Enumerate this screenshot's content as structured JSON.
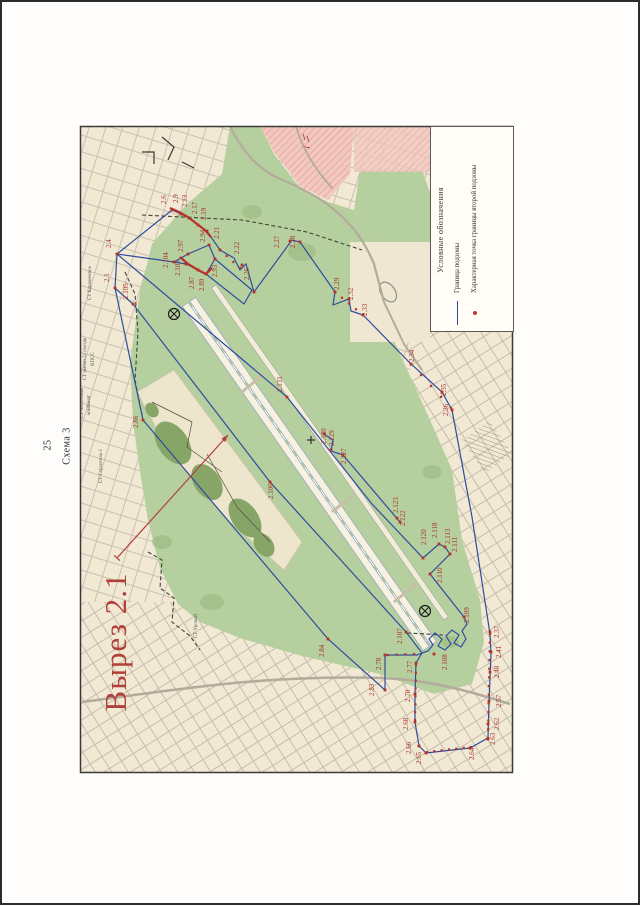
{
  "page": {
    "number": "25",
    "scheme": "Схема 3",
    "cutout": "Вырез 2.1"
  },
  "legend": {
    "title": "Условные обозначения",
    "items": [
      {
        "symbol": "line",
        "label": "Граница  подзоны"
      },
      {
        "symbol": "point",
        "label": "Характерная точка границы второй подзоны"
      }
    ]
  },
  "map": {
    "colors": {
      "boundary": "#2e4da0",
      "point": "#b5332a",
      "point_label": "#a8332c",
      "dashed": "#3f4538",
      "area_label": "#55534a",
      "arrow": "#b2403a"
    },
    "area_labels": [
      [
        "СТ Карачевское",
        89,
        281
      ],
      [
        "СТ имени 21 съезда",
        84,
        357
      ],
      [
        "КПСС",
        92,
        357
      ],
      [
        "СТ Молочный",
        81,
        401
      ],
      [
        "комбинат",
        88,
        403
      ],
      [
        "СТ Строитель-1",
        100,
        464
      ],
      [
        "СТ Урожай",
        195,
        624
      ]
    ],
    "points": [
      [
        "2.1",
        113,
        286,
        107,
        280
      ],
      [
        "2.4",
        115,
        252,
        109,
        246
      ],
      [
        "2.6",
        170,
        208,
        164,
        202
      ],
      [
        "2.9",
        179,
        212,
        176,
        201
      ],
      [
        "2.13",
        187,
        216,
        185,
        205
      ],
      [
        "2.17",
        196,
        223,
        195,
        212
      ],
      [
        "2.19",
        205,
        229,
        204,
        218
      ],
      [
        "2.21",
        218,
        248,
        217,
        237
      ],
      [
        "2.22",
        240,
        263,
        237,
        252
      ],
      [
        "2.26",
        252,
        290,
        247,
        278
      ],
      [
        "2.27",
        288,
        239,
        277,
        246
      ],
      [
        "2.28",
        298,
        240,
        293,
        246
      ],
      [
        "2.29",
        333,
        290,
        337,
        288
      ],
      [
        "2.32",
        347,
        297,
        351,
        298
      ],
      [
        "2.33",
        361,
        313,
        365,
        314
      ],
      [
        "2.34",
        409,
        362,
        412,
        360
      ],
      [
        "2.35",
        440,
        390,
        444,
        394
      ],
      [
        "2.36",
        450,
        408,
        446,
        414
      ],
      [
        "2.37",
        488,
        630,
        497,
        636
      ],
      [
        "2.41",
        489,
        650,
        499,
        656
      ],
      [
        "2.48",
        488,
        670,
        497,
        676
      ],
      [
        "2.57",
        487,
        699,
        499,
        705
      ],
      [
        "2.62",
        486,
        722,
        497,
        728
      ],
      [
        "2.63",
        486,
        737,
        493,
        743
      ],
      [
        "2.64",
        468,
        746,
        472,
        758
      ],
      [
        "2.65",
        424,
        751,
        419,
        762
      ],
      [
        "2.66",
        417,
        744,
        409,
        752
      ],
      [
        "2.68",
        413,
        720,
        406,
        728
      ],
      [
        "2.70",
        413,
        692,
        408,
        700
      ],
      [
        "2.77",
        414,
        661,
        410,
        671
      ],
      [
        "2.78",
        383,
        653,
        379,
        668
      ],
      [
        "2.83",
        383,
        688,
        372,
        694
      ],
      [
        "2.84",
        326,
        637,
        322,
        655
      ],
      [
        "2.86",
        141,
        418,
        136,
        426
      ],
      [
        "2.87",
        196,
        268,
        192,
        287
      ],
      [
        "2.89",
        204,
        272,
        202,
        289
      ],
      [
        "2.93",
        213,
        257,
        215,
        275
      ],
      [
        "2.94",
        207,
        243,
        203,
        240
      ],
      [
        "2.97",
        186,
        252,
        181,
        250
      ],
      [
        "2.103",
        184,
        262,
        178,
        274
      ],
      [
        "2.104",
        172,
        260,
        166,
        266
      ],
      [
        "2.105",
        131,
        302,
        126,
        297
      ],
      [
        "2.106",
        268,
        480,
        271,
        497
      ],
      [
        "2.107",
        404,
        630,
        400,
        642
      ],
      [
        "2.108",
        432,
        652,
        445,
        668
      ],
      [
        "2.109",
        462,
        615,
        467,
        621
      ],
      [
        "2.110",
        428,
        572,
        440,
        581
      ],
      [
        "2.111",
        448,
        552,
        455,
        550
      ],
      [
        "2.113",
        443,
        545,
        448,
        542
      ],
      [
        "2.118",
        437,
        542,
        435,
        536
      ],
      [
        "2.120",
        421,
        556,
        424,
        543
      ],
      [
        "2.122",
        398,
        520,
        403,
        524
      ],
      [
        "2.123",
        395,
        516,
        396,
        511
      ],
      [
        "2.127",
        341,
        453,
        344,
        462
      ],
      [
        "2.129",
        329,
        448,
        332,
        444
      ],
      [
        "2.130",
        322,
        432,
        324,
        442
      ],
      [
        "2.131",
        285,
        395,
        280,
        390
      ]
    ],
    "boundary": [
      [
        [
          113,
          286
        ],
        [
          115,
          252
        ],
        [
          170,
          208
        ],
        [
          179,
          212
        ],
        [
          187,
          216
        ],
        [
          196,
          223
        ],
        [
          205,
          229
        ],
        [
          218,
          248
        ],
        [
          232,
          256
        ],
        [
          238,
          268
        ],
        [
          244,
          262
        ],
        [
          252,
          290
        ],
        [
          290,
          238
        ],
        [
          298,
          240
        ],
        [
          333,
          290
        ],
        [
          331,
          303
        ],
        [
          347,
          297
        ],
        [
          349,
          309
        ],
        [
          361,
          313
        ],
        [
          409,
          362
        ],
        [
          440,
          390
        ],
        [
          450,
          408
        ],
        [
          470,
          515
        ],
        [
          488,
          632
        ],
        [
          489,
          652
        ],
        [
          487,
          700
        ],
        [
          486,
          736
        ],
        [
          468,
          746
        ],
        [
          424,
          751
        ],
        [
          417,
          744
        ],
        [
          413,
          720
        ],
        [
          413,
          692
        ],
        [
          414,
          661
        ],
        [
          420,
          651
        ]
      ],
      [
        [
          420,
          651
        ],
        [
          426,
          649
        ],
        [
          431,
          643
        ],
        [
          427,
          637
        ],
        [
          433,
          631
        ],
        [
          440,
          637
        ],
        [
          436,
          644
        ],
        [
          443,
          648
        ],
        [
          449,
          642
        ],
        [
          444,
          634
        ],
        [
          450,
          628
        ],
        [
          457,
          633
        ],
        [
          452,
          641
        ],
        [
          459,
          645
        ],
        [
          464,
          637
        ],
        [
          460,
          629
        ],
        [
          465,
          622
        ],
        [
          462,
          615
        ]
      ],
      [
        [
          462,
          615
        ],
        [
          428,
          572
        ],
        [
          448,
          552
        ],
        [
          443,
          545
        ],
        [
          437,
          542
        ],
        [
          421,
          556
        ],
        [
          370,
          502
        ],
        [
          285,
          395
        ],
        [
          115,
          252
        ]
      ],
      [
        [
          113,
          286
        ],
        [
          141,
          418
        ],
        [
          326,
          637
        ],
        [
          383,
          688
        ],
        [
          383,
          653
        ],
        [
          415,
          653
        ],
        [
          420,
          651
        ]
      ],
      [
        [
          113,
          286
        ],
        [
          131,
          302
        ],
        [
          268,
          480
        ],
        [
          404,
          630
        ],
        [
          420,
          651
        ]
      ],
      [
        [
          172,
          260
        ],
        [
          184,
          262
        ],
        [
          196,
          268
        ],
        [
          204,
          272
        ],
        [
          213,
          257
        ],
        [
          207,
          243
        ],
        [
          186,
          252
        ],
        [
          172,
          260
        ]
      ],
      [
        [
          213,
          257
        ],
        [
          250,
          288
        ],
        [
          242,
          302
        ],
        [
          204,
          272
        ]
      ],
      [
        [
          115,
          252
        ],
        [
          172,
          260
        ]
      ],
      [
        [
          322,
          432
        ],
        [
          331,
          438
        ],
        [
          329,
          449
        ],
        [
          341,
          453
        ],
        [
          398,
          520
        ]
      ]
    ],
    "dashed": [
      [
        [
          140,
          213
        ],
        [
          240,
          218
        ],
        [
          305,
          230
        ],
        [
          360,
          248
        ]
      ],
      [
        [
          123,
          270
        ],
        [
          133,
          292
        ],
        [
          136,
          330
        ],
        [
          133,
          378
        ],
        [
          141,
          418
        ]
      ],
      [
        [
          146,
          550
        ],
        [
          160,
          558
        ],
        [
          158,
          586
        ],
        [
          172,
          596
        ],
        [
          170,
          620
        ],
        [
          188,
          634
        ],
        [
          198,
          648
        ]
      ],
      [
        [
          405,
          631
        ],
        [
          441,
          633
        ]
      ]
    ],
    "dot_chains": [
      {
        "a": [
          488,
          632
        ],
        "b": [
          486,
          736
        ],
        "n": 13
      },
      {
        "a": [
          469,
          745
        ],
        "b": [
          425,
          750
        ],
        "n": 7
      },
      {
        "a": [
          413,
          718
        ],
        "b": [
          414,
          663
        ],
        "n": 8
      },
      {
        "a": [
          409,
          362
        ],
        "b": [
          449,
          406
        ],
        "n": 5
      },
      {
        "a": [
          218,
          248
        ],
        "b": [
          238,
          266
        ],
        "n": 4
      },
      {
        "a": [
          333,
          290
        ],
        "b": [
          361,
          313
        ],
        "n": 5
      },
      {
        "a": [
          386,
          653
        ],
        "b": [
          412,
          652
        ],
        "n": 4
      }
    ],
    "red_arcs": [
      [
        [
          168,
          206
        ],
        [
          177,
          210
        ],
        [
          186,
          215
        ],
        [
          195,
          222
        ],
        [
          203,
          228
        ],
        [
          209,
          235
        ]
      ],
      [
        [
          178,
          255
        ],
        [
          186,
          262
        ],
        [
          196,
          268
        ],
        [
          204,
          272
        ],
        [
          210,
          266
        ]
      ]
    ],
    "cross_circles": [
      [
        172,
        312
      ],
      [
        423,
        609
      ]
    ],
    "plus_marks": [
      [
        309,
        438
      ]
    ],
    "cutout_arrow": {
      "from": [
        115,
        556
      ],
      "to": [
        226,
        433
      ]
    }
  }
}
